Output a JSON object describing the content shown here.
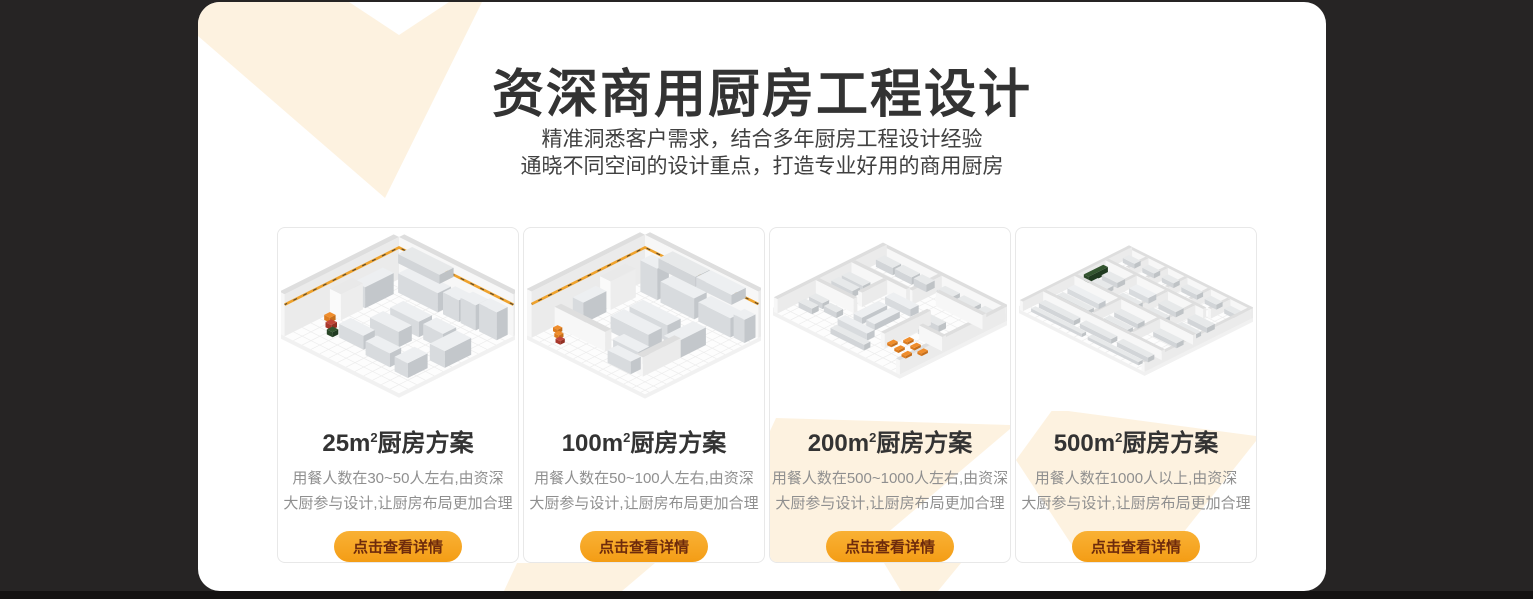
{
  "theme": {
    "page_bg": "#262424",
    "bottom_bar_bg": "#141212",
    "panel_bg": "#ffffff",
    "accent_orange": "#f6a41f",
    "decor_cream": "#fdf2e0",
    "title_color": "#333333",
    "subtitle_color": "#404040",
    "desc_color": "#8f8f8f",
    "button_text_color": "#6e2b0c"
  },
  "header": {
    "title": "资深商用厨房工程设计",
    "subtitle_line1": "精准洞悉客户需求，结合多年厨房工程设计经验",
    "subtitle_line2": "通晓不同空间的设计重点，打造专业好用的商用厨房"
  },
  "cards": [
    {
      "area": "25m",
      "area_sup": "2",
      "title_suffix": "厨房方案",
      "desc_line1": "用餐人数在30~50人左右,由资深",
      "desc_line2": "大厨参与设计,让厨房布局更加合理",
      "button_label": "点击查看详情",
      "render_name": "25-sqm-kitchen-isometric-render"
    },
    {
      "area": "100m",
      "area_sup": "2",
      "title_suffix": "厨房方案",
      "desc_line1": "用餐人数在50~100人左右,由资深",
      "desc_line2": "大厨参与设计,让厨房布局更加合理",
      "button_label": "点击查看详情",
      "render_name": "100-sqm-kitchen-isometric-render"
    },
    {
      "area": "200m",
      "area_sup": "2",
      "title_suffix": "厨房方案",
      "desc_line1": "用餐人数在500~1000人左右,由资深",
      "desc_line2": "大厨参与设计,让厨房布局更加合理",
      "button_label": "点击查看详情",
      "render_name": "200-sqm-kitchen-isometric-render"
    },
    {
      "area": "500m",
      "area_sup": "2",
      "title_suffix": "厨房方案",
      "desc_line1": "用餐人数在1000人以上,由资深",
      "desc_line2": "大厨参与设计,让厨房布局更加合理",
      "button_label": "点击查看详情",
      "render_name": "500-sqm-kitchen-isometric-render"
    }
  ]
}
